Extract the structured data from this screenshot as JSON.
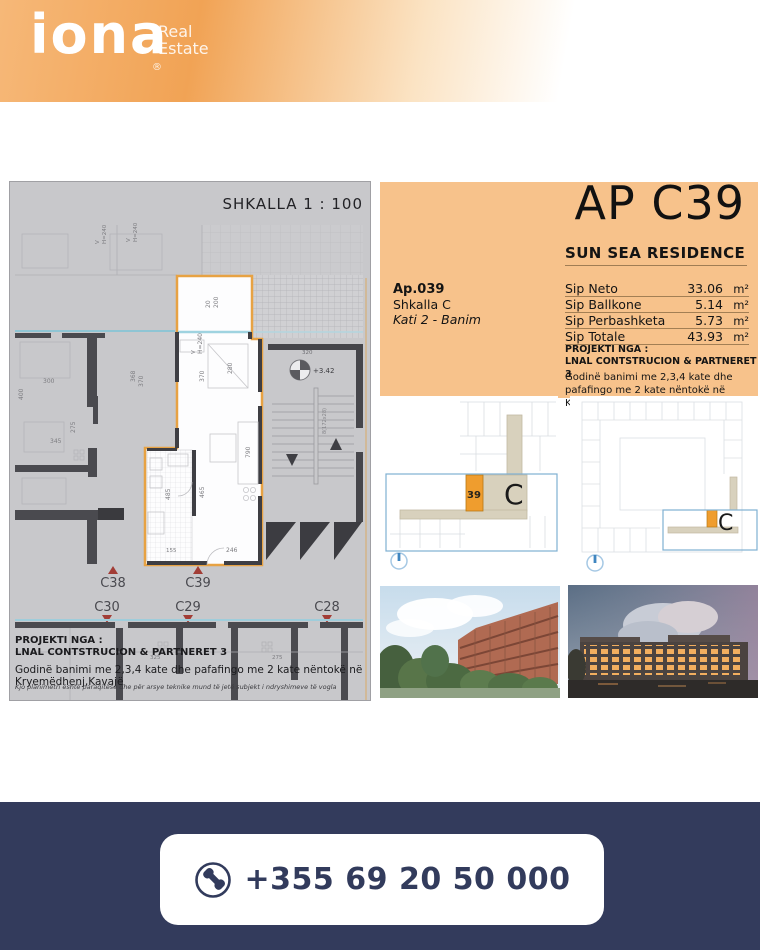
{
  "brand": {
    "wordmark": "iona",
    "sub_line1": "Real",
    "sub_line2": "Estate",
    "registered": "®"
  },
  "floorplan": {
    "scale_label": "SHKALLA 1 : 100",
    "markers_up": [
      "C38",
      "C39"
    ],
    "markers_down": [
      "C30",
      "C29",
      "C28"
    ],
    "stair": {
      "width_label": "320",
      "level_label": "+3.42",
      "steps_label": "8(172x28)"
    },
    "dims": {
      "balcony_t": "20",
      "balcony_w": "200",
      "window_v": "V",
      "window_h": "H=240",
      "room_w": "370",
      "room_w2": "280",
      "room_l": "465",
      "bath_l": "485",
      "right_l": "790",
      "entry_w": "246",
      "bath_w": "155",
      "left_a": "300",
      "left_b": "345",
      "left_c": "275",
      "left_d": "368",
      "left_e": "370",
      "left_f": "400",
      "low_a": "325",
      "low_b": "275"
    },
    "projekti_label": "PROJEKTI NGA :",
    "projekti_name": "LNAL CONTSTRUCION & PARTNERET 3",
    "building_description": "Godinë banimi me 2,3,4 kate dhe pafafingo me 2 kate nëntokë në Kryemëdhenj,Kavajë",
    "disclaimer": "Kjo planimetri është paraqitëse dhe për arsye teknike mund të jetë subjekt i ndryshimeve të vogla"
  },
  "info_panel": {
    "apartment_code": "AP C39",
    "residence_name": "SUN SEA RESIDENCE",
    "apartment_number": "Ap.039",
    "staircase": "Shkalla C",
    "floor_use": "Kati 2 - Banim",
    "areas": [
      {
        "label": "Sip Neto",
        "value": "33.06",
        "unit": "m²"
      },
      {
        "label": "Sip Ballkone",
        "value": "5.14",
        "unit": "m²"
      },
      {
        "label": "Sip Perbashketa",
        "value": "5.73",
        "unit": "m²"
      },
      {
        "label": "Sip Totale",
        "value": "43.93",
        "unit": "m²"
      }
    ],
    "projekti_label": "PROJEKTI NGA :",
    "projekti_name": "LNAL CONTSTRUCION & PARTNERET 3",
    "building_description": "Godinë banimi me 2,3,4 kate dhe pafafingo me 2 kate nëntokë në Kryemëdhenj,Kavajë"
  },
  "diagrams": {
    "unit_number": "39",
    "block_letter": "C"
  },
  "contact": {
    "phone": "+355 69 20 50 000"
  },
  "colors": {
    "panel_orange": "#f7c28b",
    "unit_orange": "#ef9d2e",
    "plan_outline_orange": "#e7a243",
    "navy": "#333b5c",
    "marker_red": "#a23d36"
  }
}
